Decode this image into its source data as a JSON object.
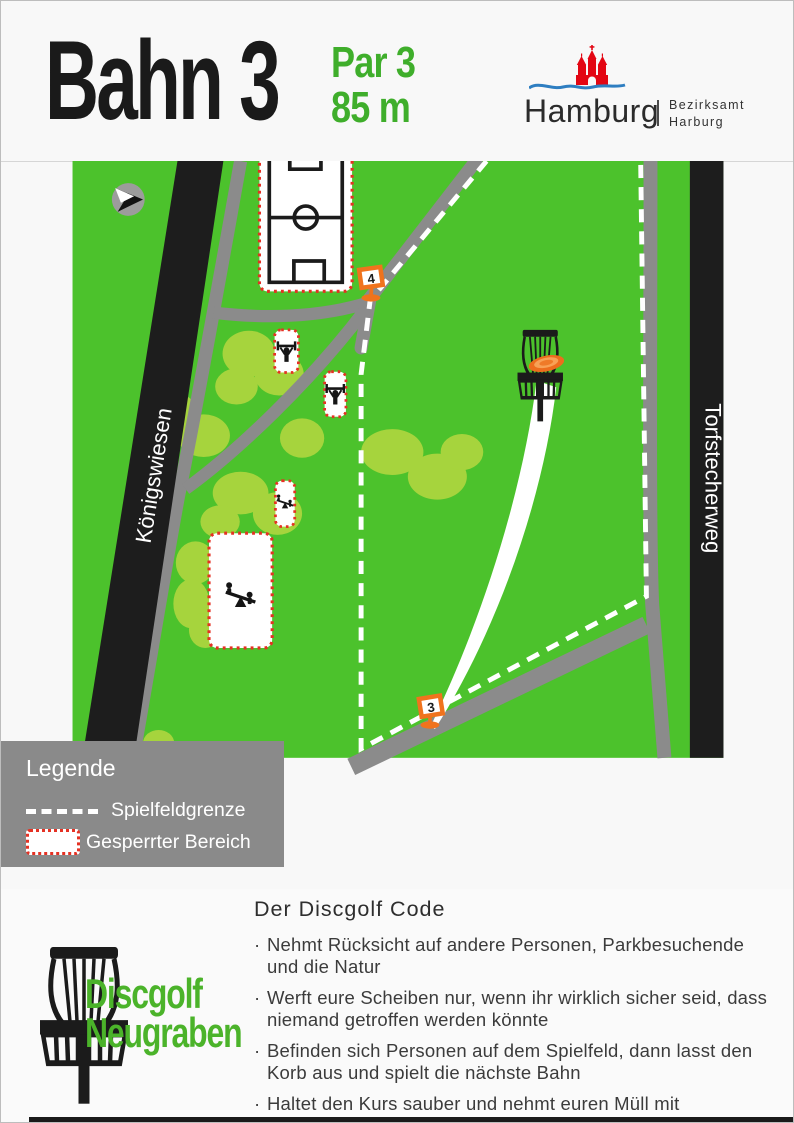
{
  "header": {
    "title": "Bahn 3",
    "par": "Par 3",
    "distance": "85 m",
    "logo": {
      "city": "Hamburg",
      "dept_line1": "Bezirksamt",
      "dept_line2": "Harburg"
    }
  },
  "map": {
    "street_left": "Königswiesen",
    "street_right": "Torfstecherweg",
    "tee_markers": [
      {
        "label": "3"
      },
      {
        "label": "4"
      }
    ],
    "icons": [
      "compass-icon",
      "disc-golf-basket-icon",
      "disc-icon",
      "soccer-field-icon",
      "fitness-station-icon",
      "seesaw-icon"
    ]
  },
  "legend": {
    "title": "Legende",
    "boundary_label": "Spielfeldgrenze",
    "restricted_label": "Gesperrter Bereich"
  },
  "code": {
    "title": "Der Discgolf Code",
    "bullet": "·",
    "rules": [
      "Nehmt Rücksicht auf andere Personen, Parkbesuchende und die Natur",
      "Werft eure Scheiben nur, wenn ihr wirklich sicher seid, dass niemand getroffen werden könnte",
      "Befinden sich Personen auf dem Spielfeld, dann lasst den Korb aus und spielt die nächste Bahn",
      "Haltet den Kurs sauber und nehmt euren Müll mit"
    ]
  },
  "brand": {
    "line1": "Discgolf",
    "line2": "Neugraben"
  },
  "colors": {
    "field_green": "#4cc22c",
    "tree_green": "#a6d43d",
    "path_gray": "#8b8b8b",
    "road_black": "#1d1d1d",
    "marker_orange": "#f0731d",
    "restricted_red": "#e53123",
    "brand_green": "#4bb32a",
    "title_green": "#3fae2b",
    "castle_red": "#e30613",
    "wave_blue": "#2e7ec1"
  }
}
